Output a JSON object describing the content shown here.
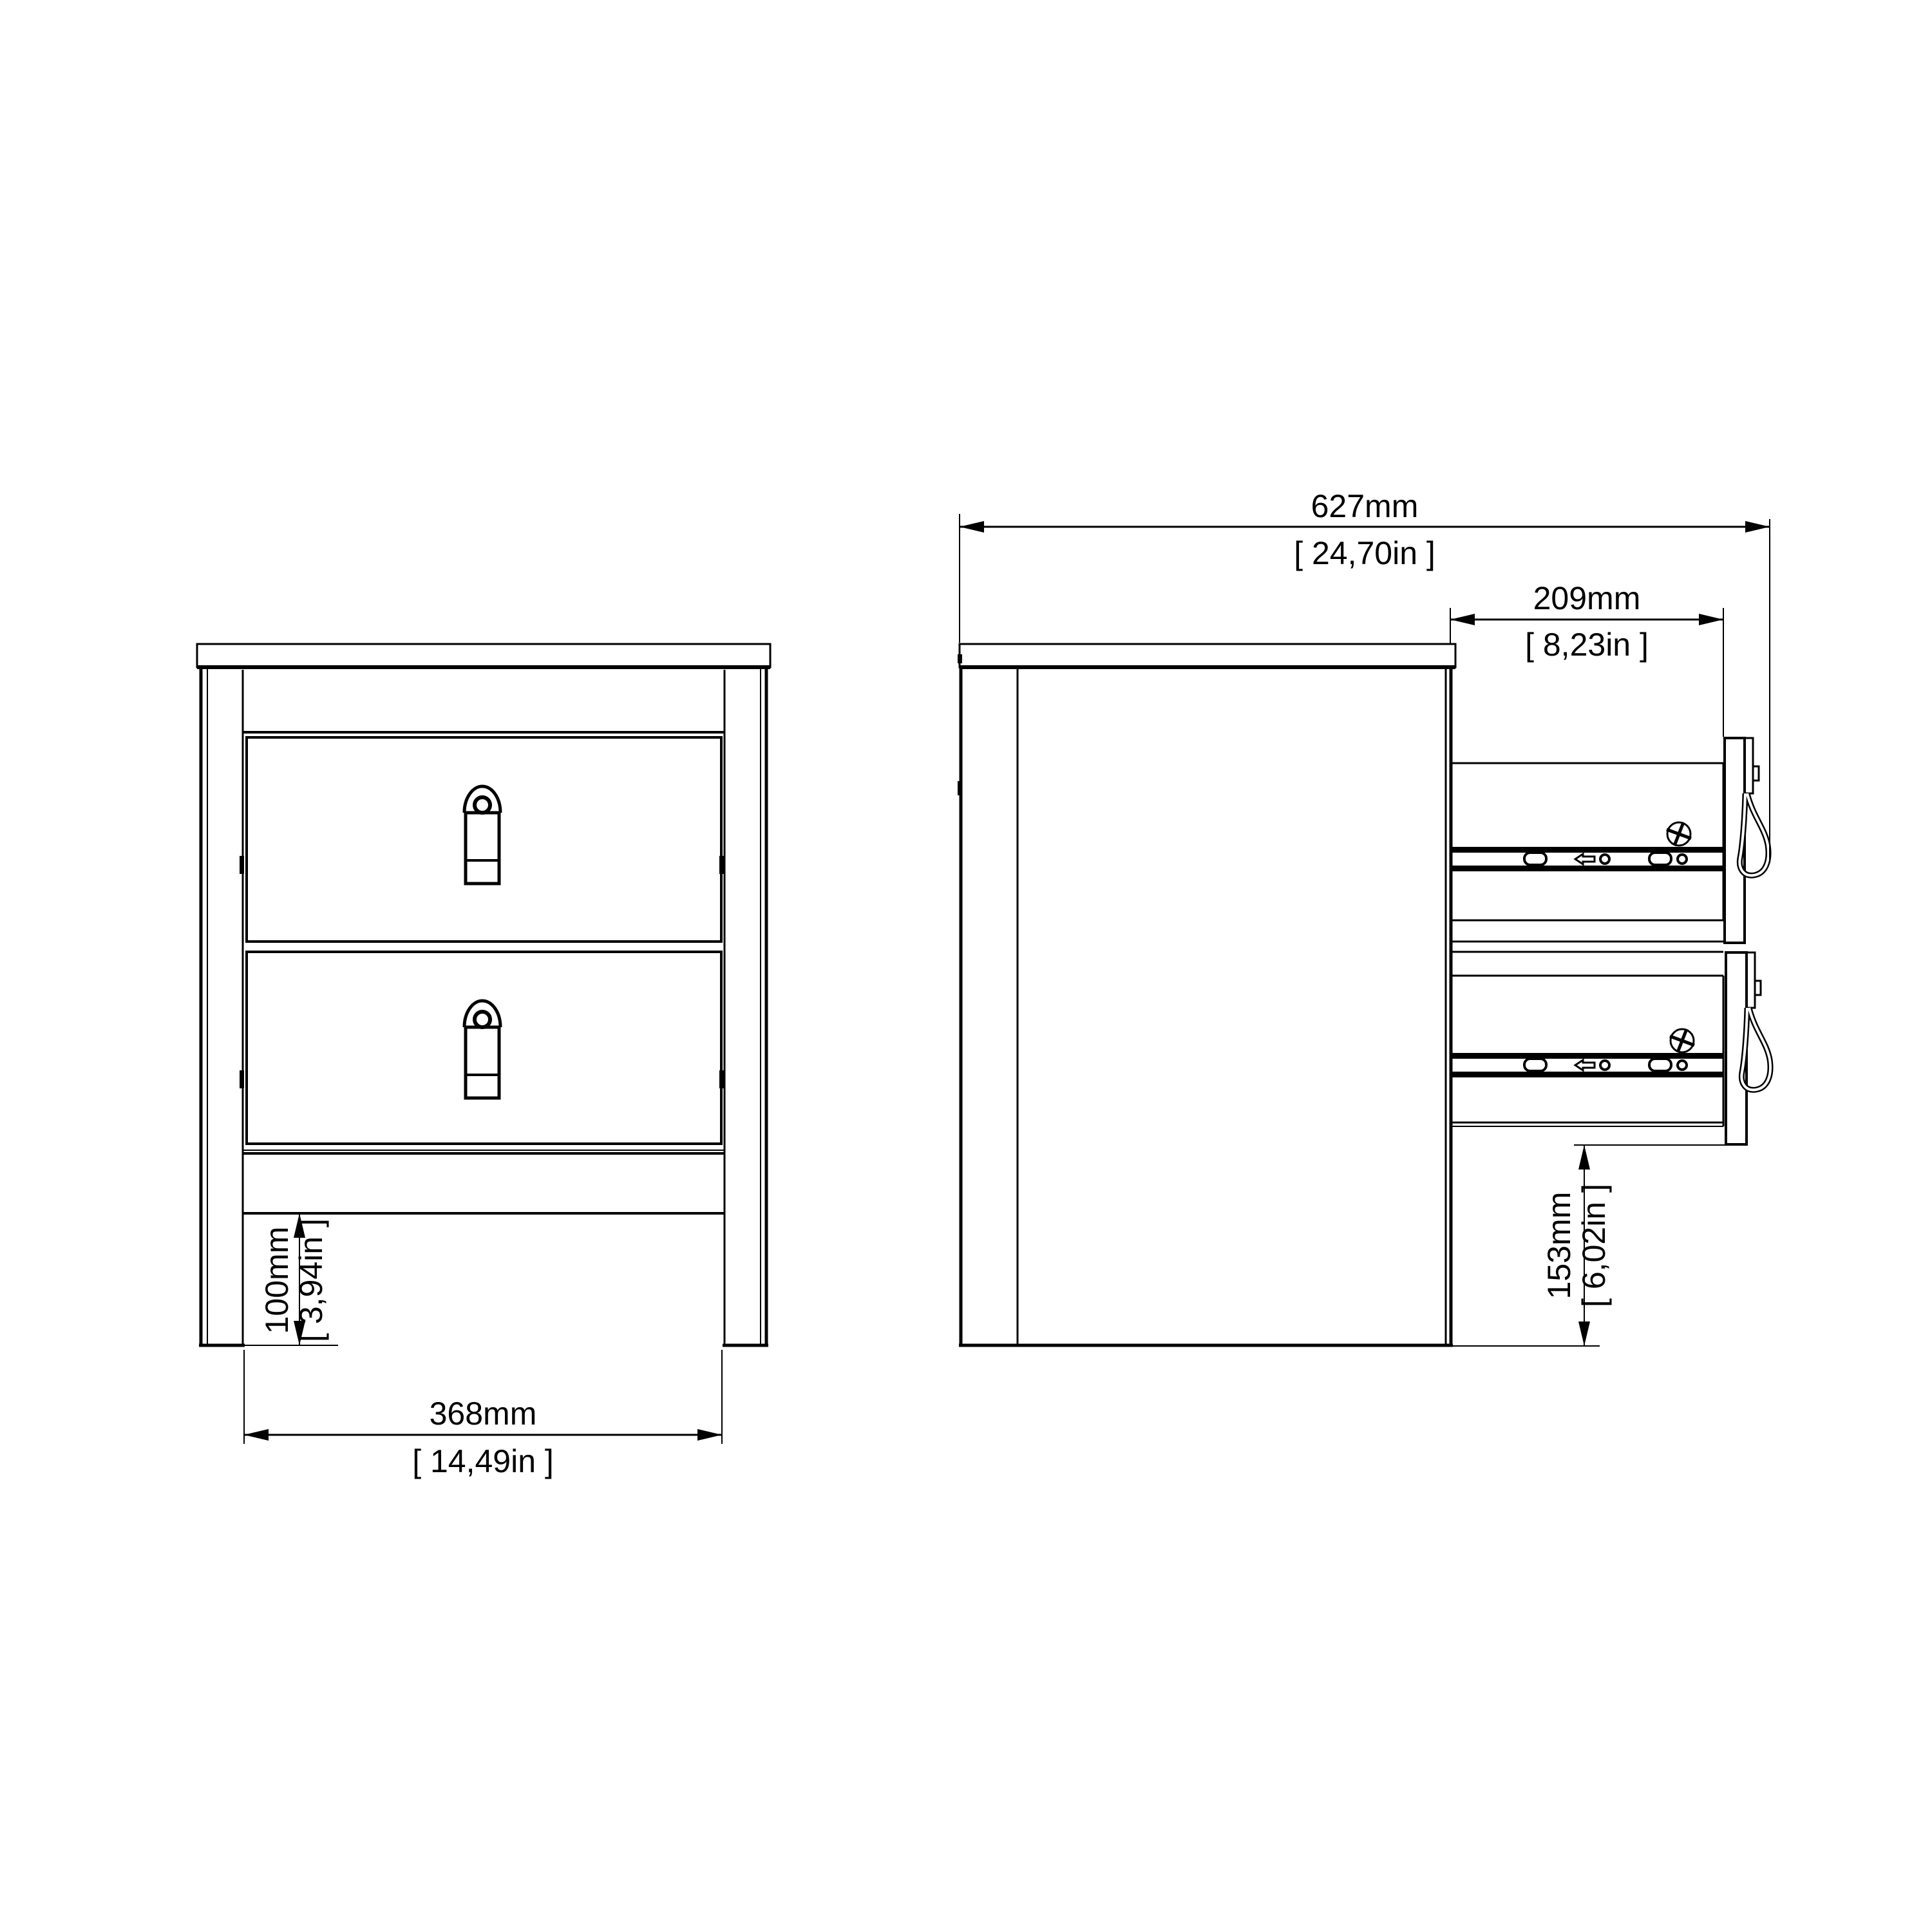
{
  "colors": {
    "background": "#ffffff",
    "line": "#000000"
  },
  "drawing": {
    "subject": "two-drawer bedside table technical drawing",
    "views": [
      "front-elevation",
      "side-section-drawers-open"
    ]
  },
  "dimensions": {
    "total_depth": {
      "mm": "627mm",
      "inches": "[ 24,70in ]"
    },
    "drawer_extension": {
      "mm": "209mm",
      "inches": "[ 8,23in ]"
    },
    "inner_width": {
      "mm": "368mm",
      "inches": "[ 14,49in ]"
    },
    "base_clearance": {
      "mm": "100mm",
      "inches": "[ 3,94in ]"
    },
    "drawer_floor_height": {
      "mm": "153mm",
      "inches": "[ 6,02in ]"
    }
  }
}
